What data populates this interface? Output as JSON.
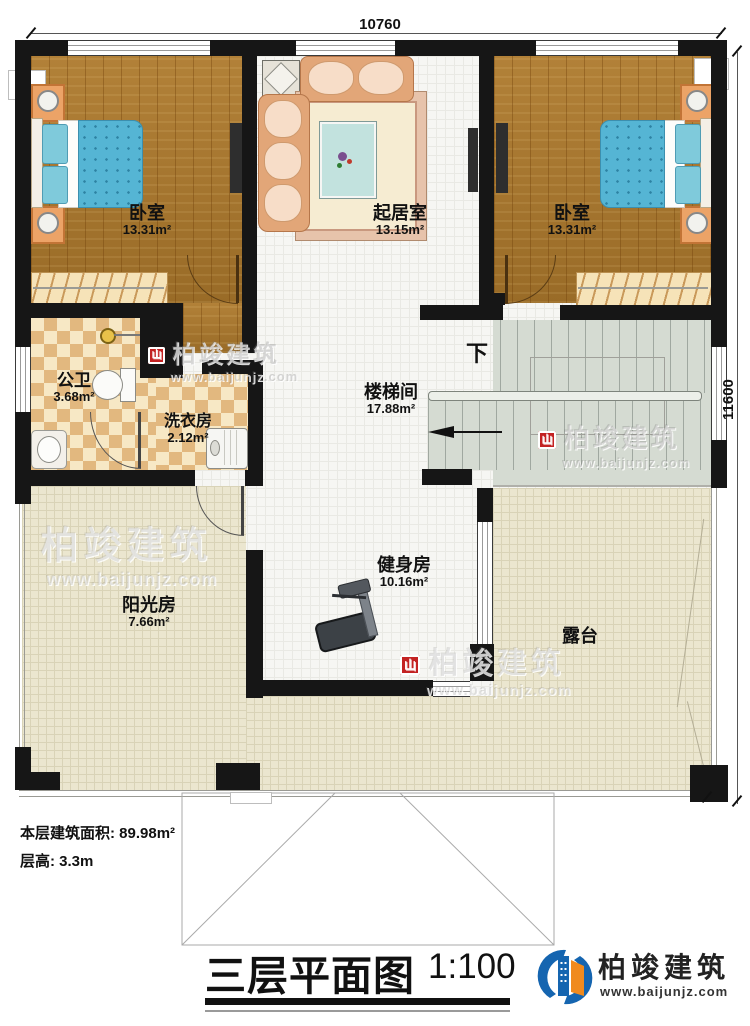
{
  "plan": {
    "dimensions": {
      "width_top": "10760",
      "height_right": "11600"
    },
    "rooms": [
      {
        "name": "卧室",
        "area": "13.31m²"
      },
      {
        "name": "起居室",
        "area": "13.15m²"
      },
      {
        "name": "卧室",
        "area": "13.31m²"
      },
      {
        "name": "公卫",
        "area": "3.68m²"
      },
      {
        "name": "洗衣房",
        "area": "2.12m²"
      },
      {
        "name": "楼梯间",
        "area": "17.88m²"
      },
      {
        "name": "健身房",
        "area": "10.16m²"
      },
      {
        "name": "阳光房",
        "area": "7.66m²"
      },
      {
        "name": "露台",
        "area": ""
      }
    ],
    "stairs": {
      "direction_label": "下"
    }
  },
  "annotations": {
    "floor_area": "本层建筑面积: 89.98m²",
    "floor_height": "层高: 3.3m"
  },
  "titleblock": {
    "title": "三层平面图",
    "scale": "1:100"
  },
  "brand": {
    "name": "柏竣建筑",
    "url": "www.baijunjz.com"
  },
  "watermark": {
    "name": "柏竣建筑",
    "url": "www.baijunjz.com"
  }
}
